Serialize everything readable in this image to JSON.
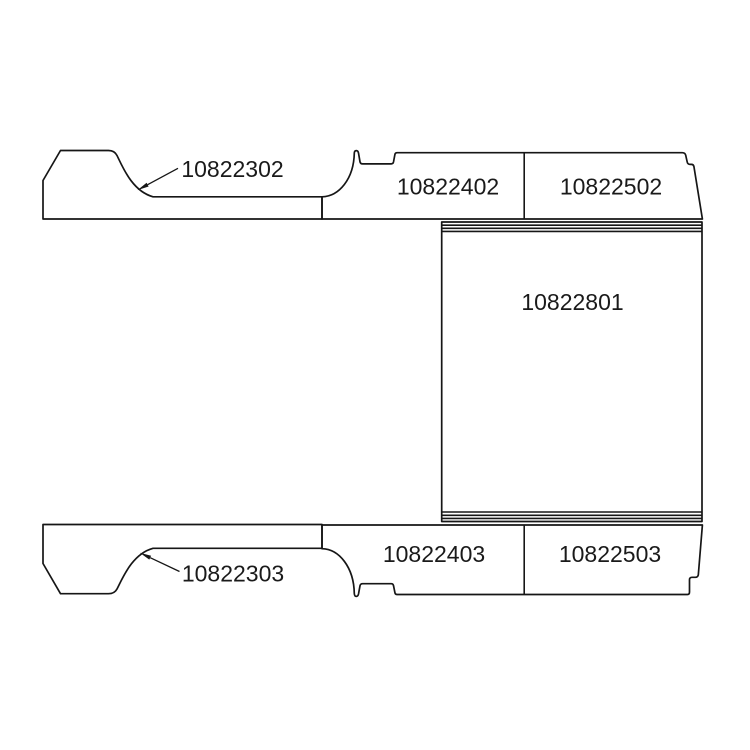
{
  "diagram": {
    "description": "Vehicle floor panel parts diagram",
    "colors": {
      "line": "#161616",
      "background": "#ffffff"
    },
    "parts": {
      "top_left": {
        "label": "10822302"
      },
      "top_middle": {
        "label": "10822402"
      },
      "top_right": {
        "label": "10822502"
      },
      "center": {
        "label": "10822801"
      },
      "bottom_left": {
        "label": "10822303"
      },
      "bottom_middle": {
        "label": "10822403"
      },
      "bottom_right": {
        "label": "10822503"
      }
    }
  }
}
